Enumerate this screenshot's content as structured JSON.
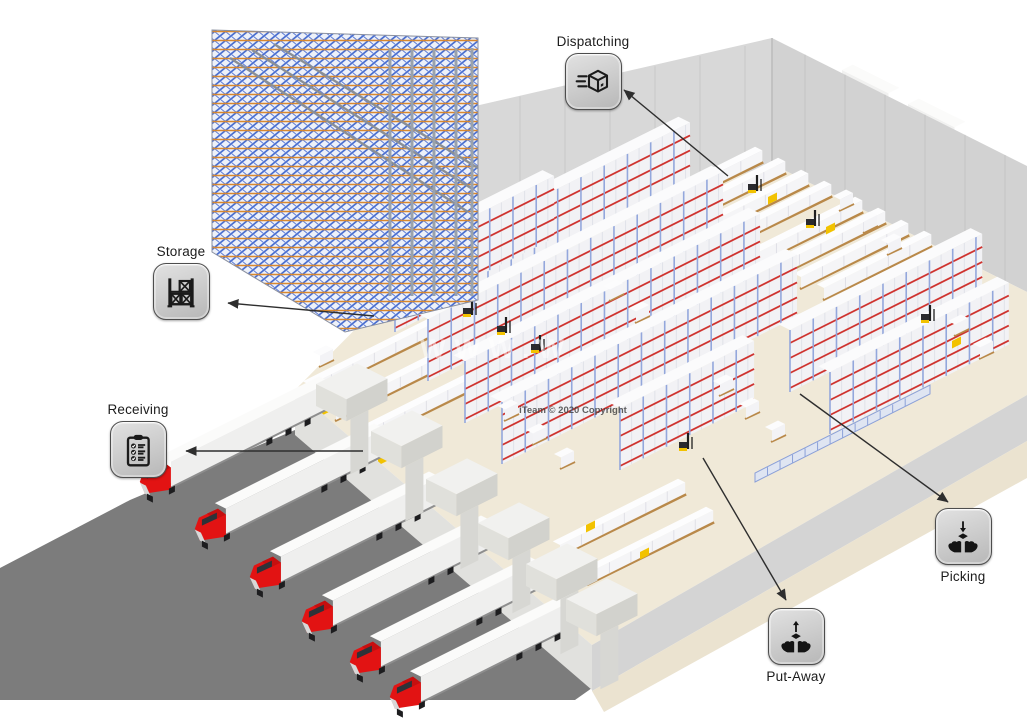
{
  "diagram": {
    "type": "warehouse-process-flow",
    "nodes": [
      {
        "id": "dispatching",
        "label": "Dispatching",
        "icon": "shipping-box-icon",
        "label_position": "above"
      },
      {
        "id": "storage",
        "label": "Storage",
        "icon": "pallet-rack-icon",
        "label_position": "above"
      },
      {
        "id": "receiving",
        "label": "Receiving",
        "icon": "receiving-checklist-icon",
        "label_position": "above"
      },
      {
        "id": "picking",
        "label": "Picking",
        "icon": "hands-receiving-box-icon",
        "label_position": "below"
      },
      {
        "id": "put_away",
        "label": "Put-Away",
        "icon": "hands-putting-box-icon",
        "label_position": "below"
      }
    ],
    "arrows": [
      {
        "target": "dispatching",
        "from": [
          728,
          176
        ],
        "to": [
          624,
          90
        ]
      },
      {
        "target": "storage",
        "from": [
          374,
          316
        ],
        "to": [
          228,
          303
        ]
      },
      {
        "target": "receiving",
        "from": [
          363,
          451
        ],
        "to": [
          186,
          451
        ]
      },
      {
        "target": "picking",
        "from": [
          800,
          394
        ],
        "to": [
          948,
          502
        ]
      },
      {
        "target": "put_away",
        "from": [
          703,
          458
        ],
        "to": [
          786,
          600
        ]
      }
    ],
    "watermarks": [
      {
        "id": "copyright",
        "text": "iTeam © 2020 Copyright"
      },
      {
        "id": "website",
        "text": "WWW.W"
      }
    ],
    "scene": {
      "receiving_truck_count": 6,
      "dispatch_truck_count": 2,
      "colors": {
        "background": "#ffffff",
        "floor": "#f0e9d8",
        "pavement": "#7c7c7c",
        "wall": "#d8d8d8",
        "apron": "#ebe3d0",
        "rack_beam_red": "#cf3430",
        "rack_post_blue": "#93a7dc",
        "asrs_blue": "#4a6fd0",
        "asrs_orange": "#d8882e",
        "truck_cab_red": "#e21313",
        "trailer_white": "#f6f6f5",
        "dock_equipment_yellow": "#f2c200",
        "pallet_brown": "#b9894a",
        "icon_tile_gray": "#cbcbcb",
        "icon_border": "#4d4d4d",
        "arrow": "#2e2e2e",
        "label_text": "#1c1c1c"
      }
    }
  }
}
